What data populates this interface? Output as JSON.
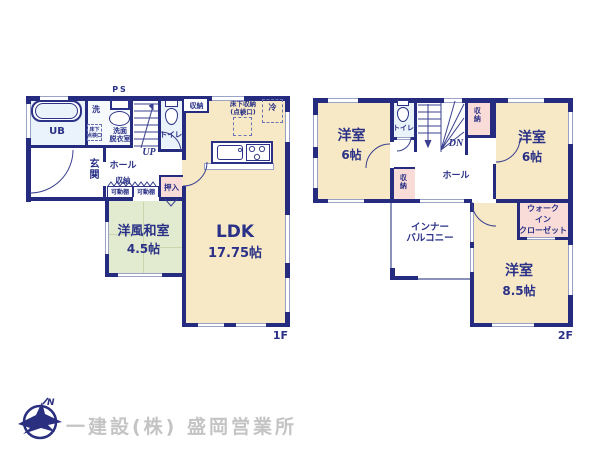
{
  "colors": {
    "wall": "#252b7e",
    "room_beige": "#f7e9c6",
    "room_green": "#e2ebcf",
    "room_pink": "#f9dcd7",
    "room_bath": "#eaf2fb",
    "footer_text": "#c4c4c4"
  },
  "floor1": {
    "floor_label": "1F",
    "ps": "PS",
    "ub": "UB",
    "washer": "洗",
    "sanitary_room": "洗面\n脱衣室",
    "underfloor_hatch": "床下\n点検口",
    "toilet": "トイレ",
    "up": "UP",
    "hall": "ホール",
    "entrance": "玄関",
    "hall_storage": "収納",
    "movable_shelf": "可動棚",
    "closet": "押入",
    "ldk_label": "LDK",
    "ldk_size": "17.75帖",
    "ldk_storage": "収納",
    "underfloor_storage": "床下収納\n(点検口)",
    "fridge": "冷",
    "washitsu_label": "洋風和室",
    "washitsu_size": "4.5帖"
  },
  "floor2": {
    "floor_label": "2F",
    "bedroom_left_label": "洋室",
    "bedroom_left_size": "6帖",
    "toilet": "トイレ",
    "dn": "DN",
    "stair_storage": "収納",
    "bedroom_right_label": "洋室",
    "bedroom_right_size": "6帖",
    "hall": "ホール",
    "hall_storage": "収納",
    "balcony": "インナー\nバルコニー",
    "wic": "ウォーク\nイン\nクローゼット",
    "bedroom_main_label": "洋室",
    "bedroom_main_size": "8.5帖"
  },
  "footer": {
    "company": "一建設(株) 盛岡営業所",
    "logo_letter": "N"
  }
}
